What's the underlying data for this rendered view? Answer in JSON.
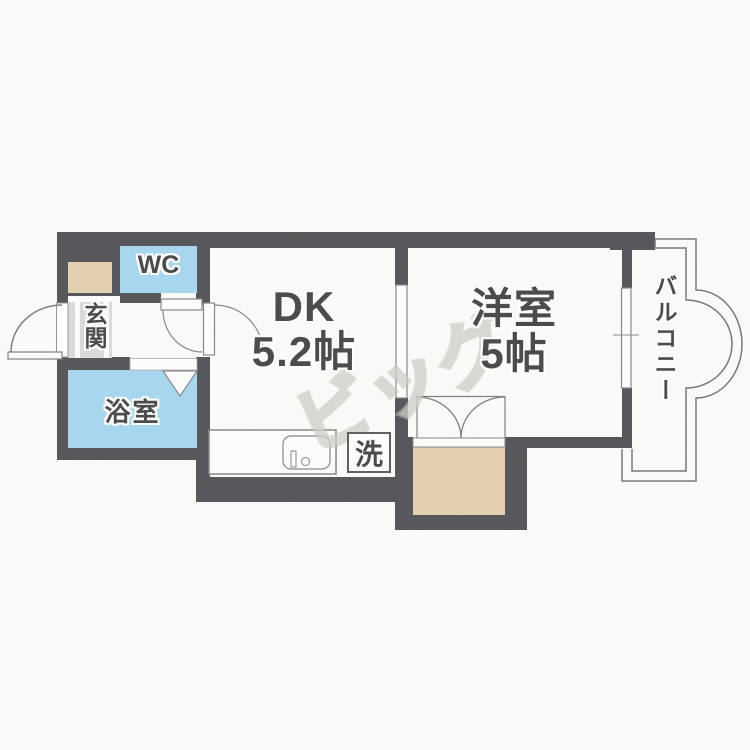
{
  "rooms": {
    "wc": {
      "label": "WC"
    },
    "entrance": {
      "label": "玄関"
    },
    "bathroom": {
      "label": "浴室"
    },
    "dining_kitchen": {
      "name": "DK",
      "size": "5.2帖"
    },
    "western_room": {
      "name": "洋室",
      "size": "5帖"
    },
    "balcony": {
      "label": "バルコニー"
    },
    "washing_machine": {
      "label": "洗"
    }
  },
  "watermark": {
    "text": "ビッグ"
  },
  "colors": {
    "wall": "#57575b",
    "water_rooms": "#a8d8f0",
    "storage": "#e6d2b2",
    "entrance_floor": "#dcdcdc",
    "outline": "#808080",
    "text": "#4a4a4a"
  }
}
